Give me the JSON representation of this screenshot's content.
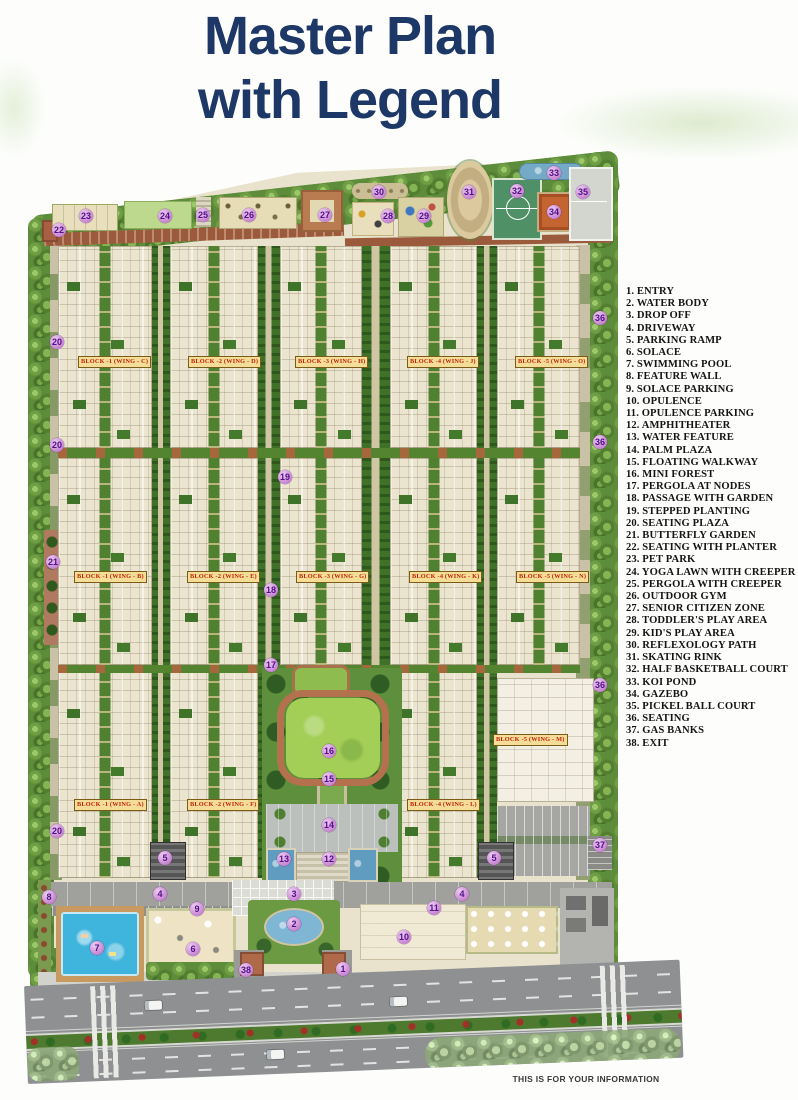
{
  "title": {
    "line1": "Master Plan",
    "line2": "with Legend"
  },
  "footer": {
    "note": "THIS IS FOR YOUR INFORMATION"
  },
  "colors": {
    "title_text": "#1d3766",
    "legend_text": "#151515",
    "marker_bg": "#c583cf",
    "marker_text": "#521089",
    "block_label_bg": "#f4dd96",
    "block_label_text": "#c22408",
    "lawn_green": "#a3cf57",
    "pool_blue": "#3fb4dc",
    "brick_path": "#a85f42",
    "court_green": "#4f9066"
  },
  "legend": {
    "items": [
      {
        "num": 1,
        "label": "ENTRY"
      },
      {
        "num": 2,
        "label": "WATER BODY"
      },
      {
        "num": 3,
        "label": "DROP OFF"
      },
      {
        "num": 4,
        "label": "DRIVEWAY"
      },
      {
        "num": 5,
        "label": "PARKING RAMP"
      },
      {
        "num": 6,
        "label": "SOLACE"
      },
      {
        "num": 7,
        "label": "SWIMMING POOL"
      },
      {
        "num": 8,
        "label": "FEATURE WALL"
      },
      {
        "num": 9,
        "label": "SOLACE PARKING"
      },
      {
        "num": 10,
        "label": "OPULENCE"
      },
      {
        "num": 11,
        "label": "OPULENCE PARKING"
      },
      {
        "num": 12,
        "label": "AMPHITHEATER"
      },
      {
        "num": 13,
        "label": "WATER FEATURE"
      },
      {
        "num": 14,
        "label": "PALM PLAZA"
      },
      {
        "num": 15,
        "label": "FLOATING WALKWAY"
      },
      {
        "num": 16,
        "label": "MINI FOREST"
      },
      {
        "num": 17,
        "label": "PERGOLA AT NODES"
      },
      {
        "num": 18,
        "label": "PASSAGE WITH GARDEN"
      },
      {
        "num": 19,
        "label": "STEPPED PLANTING"
      },
      {
        "num": 20,
        "label": "SEATING PLAZA"
      },
      {
        "num": 21,
        "label": "BUTTERFLY GARDEN"
      },
      {
        "num": 22,
        "label": "SEATING WITH PLANTER"
      },
      {
        "num": 23,
        "label": "PET PARK"
      },
      {
        "num": 24,
        "label": "YOGA LAWN WITH CREEPER"
      },
      {
        "num": 25,
        "label": "PERGOLA WITH CREEPER"
      },
      {
        "num": 26,
        "label": "OUTDOOR GYM"
      },
      {
        "num": 27,
        "label": "SENIOR CITIZEN ZONE"
      },
      {
        "num": 28,
        "label": "TODDLER'S PLAY AREA"
      },
      {
        "num": 29,
        "label": "KID'S PLAY AREA"
      },
      {
        "num": 30,
        "label": "REFLEXOLOGY PATH"
      },
      {
        "num": 31,
        "label": "SKATING RINK"
      },
      {
        "num": 32,
        "label": "HALF BASKETBALL COURT"
      },
      {
        "num": 33,
        "label": "KOI POND"
      },
      {
        "num": 34,
        "label": "GAZEBO"
      },
      {
        "num": 35,
        "label": "PICKEL BALL COURT"
      },
      {
        "num": 36,
        "label": "SEATING"
      },
      {
        "num": 37,
        "label": "GAS BANKS"
      },
      {
        "num": 38,
        "label": "EXIT"
      }
    ]
  },
  "plan": {
    "block_labels": [
      {
        "text": "BLOCK -1 (WING - C)",
        "x": 78,
        "y": 356
      },
      {
        "text": "BLOCK -2 (WING - D)",
        "x": 188,
        "y": 356
      },
      {
        "text": "BLOCK -3 (WING - H)",
        "x": 295,
        "y": 356
      },
      {
        "text": "BLOCK -4 (WING - J)",
        "x": 407,
        "y": 356
      },
      {
        "text": "BLOCK -5 (WING - O)",
        "x": 515,
        "y": 356
      },
      {
        "text": "BLOCK -1 (WING - B)",
        "x": 74,
        "y": 571
      },
      {
        "text": "BLOCK -2 (WING - E)",
        "x": 187,
        "y": 571
      },
      {
        "text": "BLOCK -3 (WING - G)",
        "x": 296,
        "y": 571
      },
      {
        "text": "BLOCK -4 (WING - K)",
        "x": 409,
        "y": 571
      },
      {
        "text": "BLOCK -5 (WING - N)",
        "x": 516,
        "y": 571
      },
      {
        "text": "BLOCK -1 (WING - A)",
        "x": 74,
        "y": 799
      },
      {
        "text": "BLOCK -2 (WING - F)",
        "x": 187,
        "y": 799
      },
      {
        "text": "BLOCK -4 (WING - L)",
        "x": 407,
        "y": 799
      },
      {
        "text": "BLOCK -5 (WING - M)",
        "x": 493,
        "y": 734
      }
    ],
    "markers": [
      {
        "n": "1",
        "x": 343,
        "y": 969
      },
      {
        "n": "2",
        "x": 294,
        "y": 924
      },
      {
        "n": "3",
        "x": 294,
        "y": 894
      },
      {
        "n": "4",
        "x": 160,
        "y": 894
      },
      {
        "n": "4",
        "x": 462,
        "y": 894
      },
      {
        "n": "5",
        "x": 165,
        "y": 858
      },
      {
        "n": "5",
        "x": 494,
        "y": 858
      },
      {
        "n": "6",
        "x": 193,
        "y": 949
      },
      {
        "n": "7",
        "x": 97,
        "y": 948
      },
      {
        "n": "8",
        "x": 49,
        "y": 897
      },
      {
        "n": "9",
        "x": 197,
        "y": 909
      },
      {
        "n": "10",
        "x": 404,
        "y": 937
      },
      {
        "n": "11",
        "x": 434,
        "y": 908
      },
      {
        "n": "12",
        "x": 329,
        "y": 859
      },
      {
        "n": "13",
        "x": 284,
        "y": 859
      },
      {
        "n": "14",
        "x": 329,
        "y": 825
      },
      {
        "n": "15",
        "x": 329,
        "y": 779
      },
      {
        "n": "16",
        "x": 329,
        "y": 751
      },
      {
        "n": "17",
        "x": 271,
        "y": 665
      },
      {
        "n": "18",
        "x": 271,
        "y": 590
      },
      {
        "n": "19",
        "x": 285,
        "y": 477
      },
      {
        "n": "20",
        "x": 57,
        "y": 342
      },
      {
        "n": "20",
        "x": 57,
        "y": 445
      },
      {
        "n": "20",
        "x": 57,
        "y": 831
      },
      {
        "n": "21",
        "x": 53,
        "y": 562
      },
      {
        "n": "22",
        "x": 59,
        "y": 230
      },
      {
        "n": "23",
        "x": 86,
        "y": 216
      },
      {
        "n": "24",
        "x": 165,
        "y": 216
      },
      {
        "n": "25",
        "x": 203,
        "y": 215
      },
      {
        "n": "26",
        "x": 249,
        "y": 215
      },
      {
        "n": "27",
        "x": 325,
        "y": 215
      },
      {
        "n": "28",
        "x": 388,
        "y": 216
      },
      {
        "n": "29",
        "x": 424,
        "y": 216
      },
      {
        "n": "30",
        "x": 379,
        "y": 192
      },
      {
        "n": "31",
        "x": 469,
        "y": 192
      },
      {
        "n": "32",
        "x": 517,
        "y": 191
      },
      {
        "n": "33",
        "x": 554,
        "y": 173
      },
      {
        "n": "34",
        "x": 554,
        "y": 212
      },
      {
        "n": "35",
        "x": 583,
        "y": 192
      },
      {
        "n": "36",
        "x": 600,
        "y": 318
      },
      {
        "n": "36",
        "x": 600,
        "y": 442
      },
      {
        "n": "36",
        "x": 600,
        "y": 685
      },
      {
        "n": "37",
        "x": 600,
        "y": 845
      },
      {
        "n": "38",
        "x": 246,
        "y": 970
      }
    ]
  }
}
